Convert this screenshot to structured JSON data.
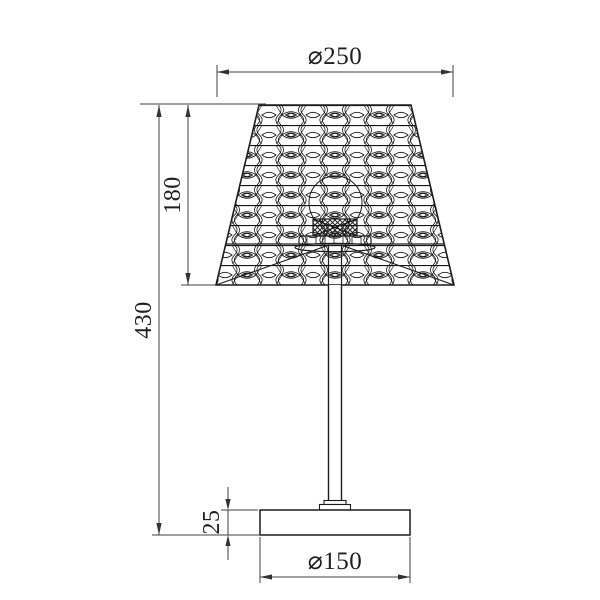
{
  "drawing": {
    "type": "technical-dimension-drawing",
    "subject": "table lamp with patterned conical shade",
    "dimensions": {
      "shade_diameter": "⌀250",
      "shade_height": "180",
      "total_height": "430",
      "base_height": "25",
      "base_diameter": "⌀150"
    },
    "colors": {
      "object_line": "#1c1c1c",
      "dimension_line": "#404040",
      "background": "#ffffff"
    }
  }
}
